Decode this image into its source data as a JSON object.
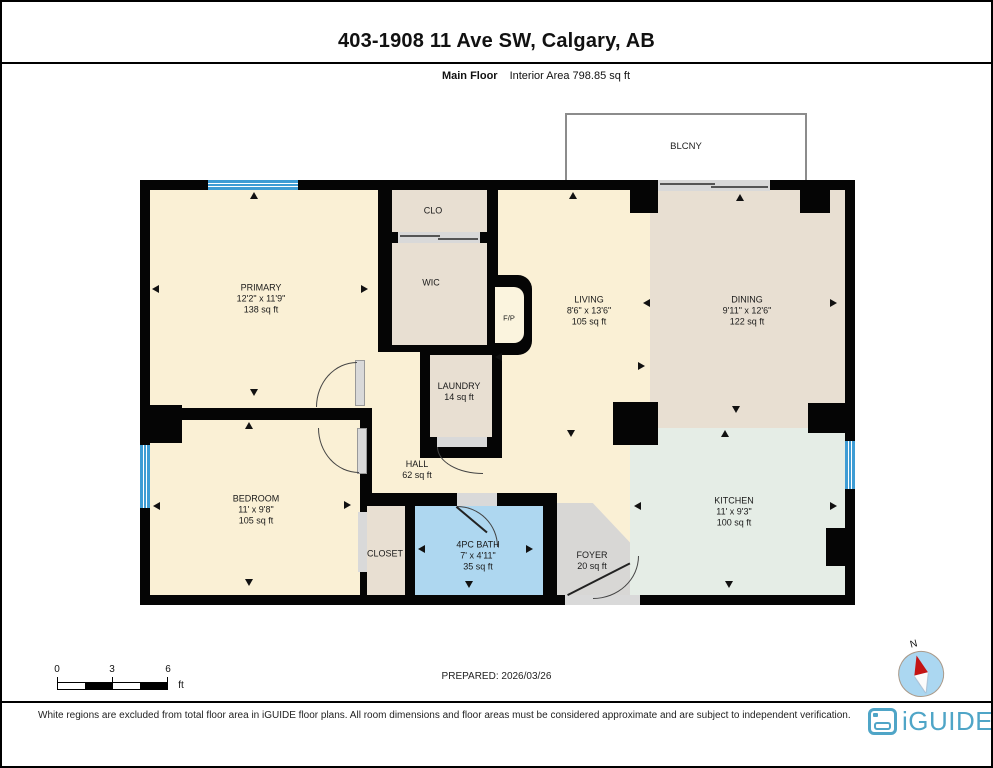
{
  "header": {
    "title": "403-1908 11 Ave SW, Calgary, AB",
    "floor_label": "Main Floor",
    "area_label": "Interior Area 798.85 sq ft"
  },
  "rooms": {
    "balcony": {
      "name": "BLCNY"
    },
    "primary": {
      "name": "PRIMARY",
      "dims": "12'2\" x 11'9\"",
      "area": "138 sq ft"
    },
    "clo": {
      "name": "CLO"
    },
    "wic": {
      "name": "WIC"
    },
    "fireplace": {
      "name": "F/P"
    },
    "living": {
      "name": "LIVING",
      "dims": "8'6\" x 13'6\"",
      "area": "105 sq ft"
    },
    "dining": {
      "name": "DINING",
      "dims": "9'11\" x 12'6\"",
      "area": "122 sq ft"
    },
    "laundry": {
      "name": "LAUNDRY",
      "area": "14 sq ft"
    },
    "hall": {
      "name": "HALL",
      "area": "62 sq ft"
    },
    "bedroom": {
      "name": "BEDROOM",
      "dims": "11' x 9'8\"",
      "area": "105 sq ft"
    },
    "closet": {
      "name": "CLOSET"
    },
    "bath": {
      "name": "4PC BATH",
      "dims": "7' x 4'11\"",
      "area": "35 sq ft"
    },
    "foyer": {
      "name": "FOYER",
      "area": "20 sq ft"
    },
    "kitchen": {
      "name": "KITCHEN",
      "dims": "11' x 9'3\"",
      "area": "100 sq ft"
    }
  },
  "scale_bar": {
    "tick_0": "0",
    "tick_3": "3",
    "tick_6": "6",
    "unit": "ft"
  },
  "footer": {
    "prepared": "PREPARED: 2026/03/26",
    "compass_label": "N",
    "disclaimer": "White regions are excluded from total floor area in iGUIDE floor plans. All room dimensions and floor areas must be considered approximate and are subject to independent verification.",
    "brand": "iGUIDE"
  },
  "colors": {
    "wall_black": "#050505",
    "room_cream": "#FAF0D5",
    "room_tan": "#E8DFD2",
    "room_blue": "#AED7F0",
    "room_gray": "#D8D7D5",
    "room_green": "#E5EDE6",
    "fp_niche": "#FBF4DE",
    "window_blue": "#3E9CD4",
    "brand_blue": "#4FA5C7"
  }
}
